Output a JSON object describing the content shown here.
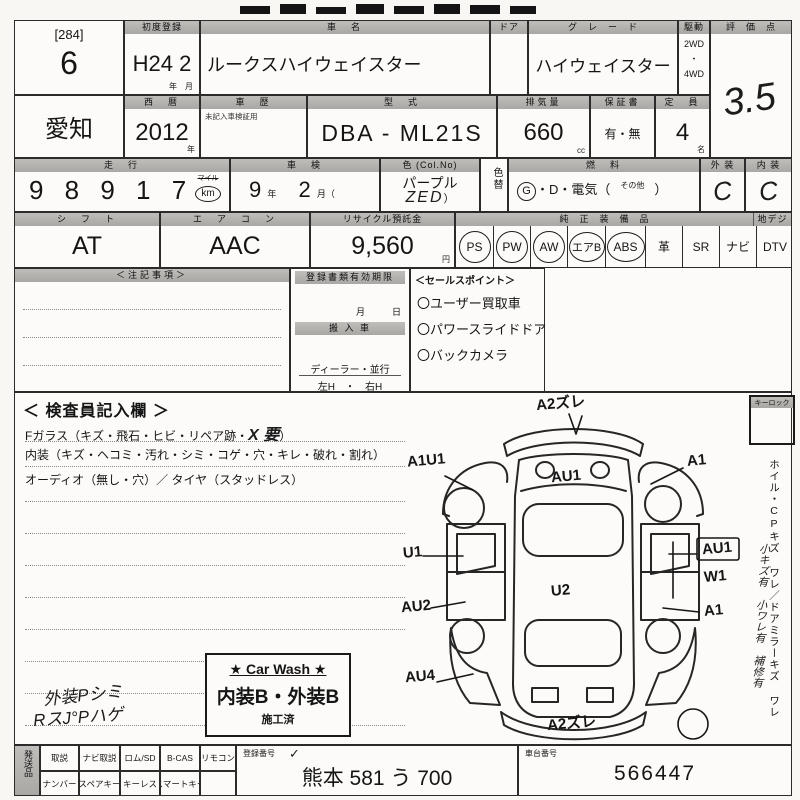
{
  "lot": {
    "bracket": "[284]",
    "number": "6"
  },
  "row1": {
    "first_reg_label": "初度登録",
    "first_reg": "H24 2",
    "first_reg_unit": "年　月",
    "name_label": "車　名",
    "name": "ルークスハイウェイスター",
    "door_label": "ドア",
    "grade_label": "グ　レ　ー　ド",
    "grade": "ハイウェイスター",
    "drive_label": "駆動",
    "drive_top": "2WD",
    "drive_dot": "・",
    "drive_bottom": "4WD",
    "score_label": "評　価　点",
    "score": "3.5"
  },
  "row2": {
    "prefecture": "愛知",
    "year_label": "西　暦",
    "year": "2012",
    "year_unit": "年",
    "history_label": "車　歴",
    "history_note": "未記入車検証用",
    "model_label": "型　式",
    "model": "DBA - ML21S",
    "cc_label": "排気量",
    "cc": "660",
    "cc_unit": "cc",
    "warranty_label": "保証書",
    "warranty": "有・無",
    "capacity_label": "定　員",
    "capacity": "4",
    "capacity_unit": "名"
  },
  "row3": {
    "mileage_label": "走　行",
    "mileage": "9 8 9 1 7",
    "mile_top": "マイル",
    "mile_unit": "km",
    "shaken_label": "車　検",
    "shaken_year": "9",
    "shaken_year_unit": "年",
    "shaken_month": "2",
    "shaken_month_unit": "月（",
    "color_label": "色 (Col.No)",
    "color": "パープル",
    "color_hand": "ZED",
    "color_close": "）",
    "color_change_label": "色替",
    "fuel_label": "燃　料",
    "fuel_g": "G",
    "fuel_rest": "・D・電気（",
    "fuel_other": "その他",
    "fuel_close": "）",
    "exterior_label": "外 装",
    "exterior": "C",
    "interior_label": "内 装",
    "interior": "C"
  },
  "row4": {
    "shift_label": "シ　フ　ト",
    "shift": "AT",
    "ac_label": "エ　ア　コ　ン",
    "ac": "AAC",
    "recycle_label": "リサイクル預託金",
    "recycle": "9,560",
    "recycle_unit": "円",
    "equip_label": "純　正　装　備　品",
    "equip_label2": "地デジ",
    "equip": [
      {
        "t": "PS"
      },
      {
        "t": "PW"
      },
      {
        "t": "AW"
      },
      {
        "t": "エアB"
      },
      {
        "t": "ABS"
      },
      {
        "t": "革"
      },
      {
        "t": "SR"
      },
      {
        "t": "ナビ"
      },
      {
        "t": "DTV"
      }
    ]
  },
  "mid": {
    "notes_label": "＜注記事項＞",
    "regdoc_label": "登録書類有効期限",
    "regdoc_units": "月　　　日",
    "import_label": "搬 入 車",
    "import_opts": "ディーラー・並行",
    "handle": "左H　・　右H",
    "sales_label": "＜セールスポイント＞",
    "sales": [
      "〇ユーザー買取車",
      "〇パワースライドドア",
      "〇バックカメラ"
    ]
  },
  "inspect": {
    "title": "＜ 検査員記入欄 ＞",
    "glass": "Fガラス（キズ・飛石・ヒビ・リペア跡・",
    "glass_hand": "X 要",
    "glass_close": "）",
    "interior": "内装（キズ・ヘコミ・汚れ・シミ・コゲ・穴・キレ・破れ・割れ）",
    "audio": "オーディオ（無し・穴）／ タイヤ（スタッドレス）",
    "hand_note1": "外装Pシミ",
    "hand_note2": "RスJ°Pハゲ"
  },
  "carwash": {
    "title": "★ Car Wash ★",
    "line": "内装B・外装B",
    "stamp": "施工済"
  },
  "rightcol": {
    "keylock": "キーロック",
    "vtext": "ホイル・CPキズ ワレ／ドアミラーキズ ワレ",
    "vhand": "小キズ有 小ワレ有 補修有"
  },
  "diagram": {
    "marks": [
      {
        "code": "A2ズレ"
      },
      {
        "code": "A1U1"
      },
      {
        "code": "AU1"
      },
      {
        "code": "A1"
      },
      {
        "code": "U1"
      },
      {
        "code": "AU1"
      },
      {
        "code": "W1"
      },
      {
        "code": "U2"
      },
      {
        "code": "AU2"
      },
      {
        "code": "A1"
      },
      {
        "code": "AU4"
      },
      {
        "code": "A2ズレ"
      }
    ]
  },
  "bottom": {
    "side_label": "発送品",
    "top_cells": [
      "取説",
      "ナビ取説",
      "ロム/SD",
      "B-CAS",
      "リモコン"
    ],
    "bottom_cells": [
      "ナンバー",
      "スペアキー",
      "キーレス",
      "スマートキー"
    ],
    "reg_label": "登録番号",
    "reg_check": "✓",
    "reg": "熊本 581 う 700",
    "chassis_label": "車台番号",
    "chassis": "566447"
  }
}
